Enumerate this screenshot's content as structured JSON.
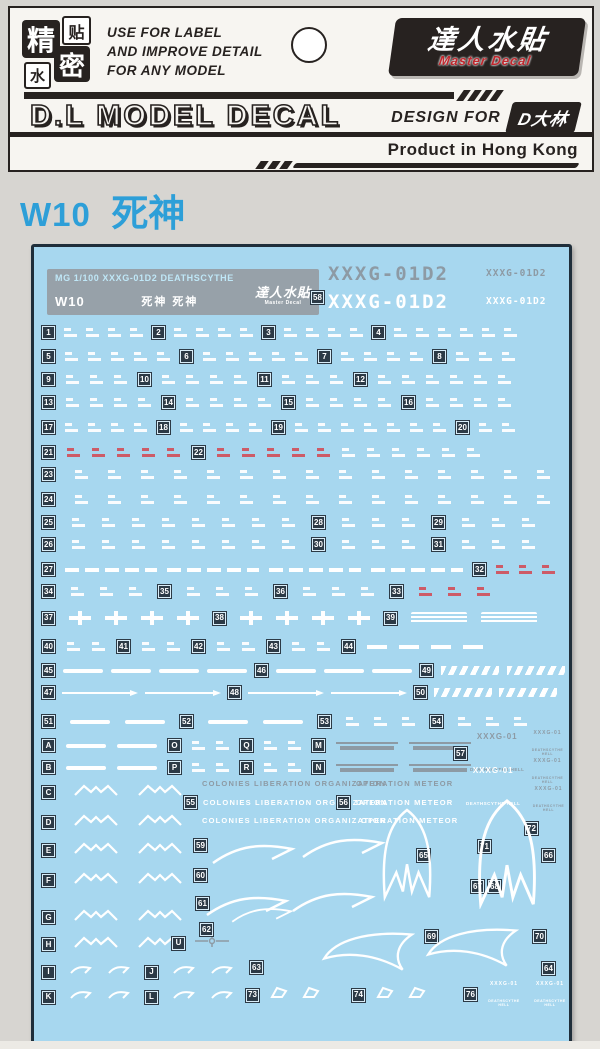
{
  "colors": {
    "page_bg": "#d7d5d1",
    "card_bg": "#f7f5f1",
    "ink": "#272220",
    "accent_red": "#c0272d",
    "title_blue": "#2d9fd8",
    "sheet_bg": "#a7d7ef",
    "sheet_border": "#1f2e3a",
    "badge_bg": "#2c3a46",
    "decal_white": "#ffffff",
    "decal_gray": "#8d9aa4",
    "decal_red": "#d05560",
    "info_box": "#97a1a9",
    "strip_bg": "#eceae5"
  },
  "header": {
    "stamp": [
      "精",
      "贴",
      "水",
      "密"
    ],
    "tagline": [
      "USE FOR LABEL",
      "AND IMPROVE DETAIL",
      "FOR ANY MODEL"
    ],
    "brand": {
      "cn": "達人水貼",
      "en": "Master Decal"
    },
    "title": "D.L MODEL DECAL",
    "design_for": "DESIGN FOR",
    "designer": "D大林",
    "origin": "Product in Hong Kong"
  },
  "sheet_title": {
    "code": "W10",
    "name": "死神"
  },
  "sheet": {
    "info": {
      "line1": "MG 1/100 XXXG-01D2 DEATHSCYTHE",
      "code": "W10",
      "name": "死神 死神",
      "logo_cn": "達人水貼",
      "logo_en": "Master Decal"
    },
    "badge58": "58",
    "codes": [
      {
        "text": "XXXG-01D2",
        "x": 294,
        "y": 16,
        "size": "lg",
        "color": "gray"
      },
      {
        "text": "XXXG-01D2",
        "x": 452,
        "y": 21,
        "size": "sm",
        "color": "gray"
      },
      {
        "text": "XXXG-01D2",
        "x": 294,
        "y": 44,
        "size": "lg",
        "color": "white"
      },
      {
        "text": "XXXG-01D2",
        "x": 452,
        "y": 49,
        "size": "sm",
        "color": "white"
      }
    ],
    "emblem": {
      "top": "XXXG-01",
      "num": "02",
      "sub": "DEATHSCYTHE HELL"
    },
    "texts": {
      "colonies": "COLONIES LIBERATION ORGANIZATION",
      "meteor": "OPERATION METEOR"
    },
    "rows": [
      {
        "y": 79,
        "gap": 9,
        "cells": [
          [
            "b",
            "1"
          ],
          [
            "g",
            4
          ],
          [
            "b",
            "2"
          ],
          [
            "g",
            4
          ],
          [
            "b",
            "3"
          ],
          [
            "g",
            4
          ],
          [
            "b",
            "4"
          ],
          [
            "g",
            6
          ]
        ]
      },
      {
        "y": 103,
        "gap": 10,
        "cells": [
          [
            "b",
            "5"
          ],
          [
            "g",
            5
          ],
          [
            "b",
            "6"
          ],
          [
            "g",
            5
          ],
          [
            "b",
            "7"
          ],
          [
            "g",
            4
          ],
          [
            "b",
            "8"
          ],
          [
            "g",
            3
          ]
        ]
      },
      {
        "y": 126,
        "gap": 11,
        "cells": [
          [
            "b",
            "9"
          ],
          [
            "g",
            3
          ],
          [
            "b",
            "10"
          ],
          [
            "g",
            4
          ],
          [
            "b",
            "11"
          ],
          [
            "g",
            3
          ],
          [
            "b",
            "12"
          ],
          [
            "g",
            6
          ]
        ]
      },
      {
        "y": 149,
        "gap": 11,
        "cells": [
          [
            "b",
            "13"
          ],
          [
            "g",
            4
          ],
          [
            "b",
            "14"
          ],
          [
            "g",
            4
          ],
          [
            "b",
            "15"
          ],
          [
            "g",
            4
          ],
          [
            "b",
            "16"
          ],
          [
            "g",
            4
          ]
        ]
      },
      {
        "y": 174,
        "gap": 10,
        "cells": [
          [
            "b",
            "17"
          ],
          [
            "g",
            4
          ],
          [
            "b",
            "18"
          ],
          [
            "g",
            4
          ],
          [
            "b",
            "19"
          ],
          [
            "g",
            7
          ],
          [
            "b",
            "20"
          ],
          [
            "g",
            2
          ]
        ]
      },
      {
        "y": 199,
        "gap": 12,
        "cells": [
          [
            "b",
            "21"
          ],
          [
            "r",
            5
          ],
          [
            "b",
            "22"
          ],
          [
            "r",
            5
          ],
          [
            "g",
            6
          ]
        ]
      },
      {
        "y": 221,
        "gap": 20,
        "cells": [
          [
            "b",
            "23"
          ],
          [
            "g",
            15
          ]
        ]
      },
      {
        "y": 246,
        "gap": 20,
        "cells": [
          [
            "b",
            "24"
          ],
          [
            "g",
            15
          ]
        ]
      },
      {
        "y": 269,
        "gap": 17,
        "cells": [
          [
            "b",
            "25"
          ],
          [
            "g",
            8
          ],
          [
            "b",
            "28"
          ],
          [
            "g",
            3
          ],
          [
            "b",
            "29"
          ],
          [
            "g",
            3
          ]
        ]
      },
      {
        "y": 291,
        "gap": 17,
        "cells": [
          [
            "b",
            "26"
          ],
          [
            "g",
            8
          ],
          [
            "b",
            "30"
          ],
          [
            "g",
            3
          ],
          [
            "b",
            "31"
          ],
          [
            "g",
            3
          ]
        ]
      },
      {
        "y": 316,
        "gap": 10,
        "cells": [
          [
            "b",
            "27"
          ],
          [
            "ld",
            4
          ],
          [
            "b",
            "32"
          ],
          [
            "r",
            3
          ]
        ]
      },
      {
        "y": 338,
        "gap": 16,
        "cells": [
          [
            "b",
            "34"
          ],
          [
            "g",
            3
          ],
          [
            "b",
            "35"
          ],
          [
            "g",
            3
          ],
          [
            "b",
            "36"
          ],
          [
            "g",
            3
          ],
          [
            "b",
            "33"
          ],
          [
            "r",
            3
          ]
        ]
      },
      {
        "y": 364,
        "gap": 14,
        "cells": [
          [
            "b",
            "37"
          ],
          [
            "x",
            4
          ],
          [
            "b",
            "38"
          ],
          [
            "x",
            4
          ],
          [
            "b",
            "39"
          ],
          [
            "sb",
            2
          ]
        ]
      },
      {
        "y": 393,
        "gap": 12,
        "cells": [
          [
            "b",
            "40"
          ],
          [
            "g",
            2
          ],
          [
            "b",
            "41"
          ],
          [
            "g",
            2
          ],
          [
            "b",
            "42"
          ],
          [
            "g",
            2
          ],
          [
            "b",
            "43"
          ],
          [
            "g",
            2
          ],
          [
            "b",
            "44"
          ],
          [
            "ds",
            4
          ]
        ]
      },
      {
        "y": 417,
        "gap": 8,
        "cells": [
          [
            "b",
            "45"
          ],
          [
            "br",
            4
          ],
          [
            "b",
            "46"
          ],
          [
            "br",
            3
          ],
          [
            "b",
            "49"
          ],
          [
            "ht",
            2
          ]
        ]
      },
      {
        "y": 439,
        "gap": 7,
        "cells": [
          [
            "b",
            "47"
          ],
          [
            "ar",
            2
          ],
          [
            "b",
            "48"
          ],
          [
            "ar",
            2
          ],
          [
            "b",
            "50"
          ],
          [
            "ht",
            2
          ]
        ]
      },
      {
        "y": 468,
        "gap": 15,
        "cells": [
          [
            "b",
            "51"
          ],
          [
            "br",
            2
          ],
          [
            "b",
            "52"
          ],
          [
            "br",
            2
          ],
          [
            "b",
            "53"
          ],
          [
            "g",
            3
          ],
          [
            "b",
            "54"
          ],
          [
            "g",
            3
          ]
        ]
      },
      {
        "y": 492,
        "gap": 11,
        "cells": [
          [
            "b",
            "A"
          ],
          [
            "br",
            2
          ],
          [
            "b",
            "O"
          ],
          [
            "g",
            2
          ],
          [
            "b",
            "Q"
          ],
          [
            "g",
            2
          ],
          [
            "b",
            "M"
          ],
          [
            "gb",
            2
          ]
        ]
      },
      {
        "y": 514,
        "gap": 11,
        "cells": [
          [
            "b",
            "B"
          ],
          [
            "br",
            2
          ],
          [
            "b",
            "P"
          ],
          [
            "g",
            2
          ],
          [
            "b",
            "R"
          ],
          [
            "g",
            2
          ],
          [
            "b",
            "N"
          ],
          [
            "gb",
            2
          ]
        ]
      },
      {
        "y": 536,
        "gap": 18,
        "cells": [
          [
            "b",
            "C"
          ],
          [
            "wg",
            2
          ]
        ]
      },
      {
        "y": 566,
        "gap": 18,
        "cells": [
          [
            "b",
            "D"
          ],
          [
            "wg",
            2
          ]
        ]
      },
      {
        "y": 594,
        "gap": 18,
        "cells": [
          [
            "b",
            "E"
          ],
          [
            "wg",
            2
          ]
        ]
      },
      {
        "y": 624,
        "gap": 18,
        "cells": [
          [
            "b",
            "F"
          ],
          [
            "wg",
            2
          ]
        ]
      },
      {
        "y": 661,
        "gap": 18,
        "cells": [
          [
            "b",
            "G"
          ],
          [
            "wg",
            2
          ]
        ]
      },
      {
        "y": 688,
        "gap": 18,
        "cells": [
          [
            "b",
            "H"
          ],
          [
            "wg",
            2
          ]
        ]
      },
      {
        "x": 138,
        "y": 687,
        "gap": 10,
        "cells": [
          [
            "b",
            "U"
          ],
          [
            "ch",
            1
          ]
        ]
      },
      {
        "y": 716,
        "gap": 14,
        "cells": [
          [
            "b",
            "I"
          ],
          [
            "hk",
            2
          ],
          [
            "b",
            "J"
          ],
          [
            "hk",
            2
          ]
        ]
      },
      {
        "y": 741,
        "gap": 14,
        "cells": [
          [
            "b",
            "K"
          ],
          [
            "hk",
            2
          ],
          [
            "b",
            "L"
          ],
          [
            "hk",
            2
          ]
        ]
      },
      {
        "x": 212,
        "y": 738,
        "gap": 10,
        "cells": [
          [
            "b",
            "73"
          ],
          [
            "bk",
            2
          ]
        ]
      },
      {
        "x": 318,
        "y": 738,
        "gap": 10,
        "cells": [
          [
            "b",
            "74"
          ],
          [
            "bk",
            2
          ]
        ]
      },
      {
        "x": 430,
        "y": 735,
        "gap": 8,
        "cells": [
          [
            "b",
            "76"
          ],
          [
            "em",
            "small",
            "white"
          ],
          [
            "em",
            "small",
            "white"
          ]
        ]
      },
      {
        "x": 168,
        "y": 532,
        "gap": 6,
        "cells": [
          [
            "t",
            "colonies",
            "t-gray"
          ]
        ]
      },
      {
        "x": 322,
        "y": 532,
        "gap": 6,
        "cells": [
          [
            "t",
            "meteor",
            "t-gray"
          ]
        ]
      },
      {
        "x": 150,
        "y": 549,
        "gap": 6,
        "cells": [
          [
            "b",
            "55"
          ],
          [
            "t",
            "colonies",
            "t-white"
          ]
        ]
      },
      {
        "x": 303,
        "y": 549,
        "gap": 6,
        "cells": [
          [
            "b",
            "56"
          ],
          [
            "t",
            "meteor",
            "t-white"
          ]
        ]
      },
      {
        "x": 168,
        "y": 569,
        "gap": 6,
        "cells": [
          [
            "t",
            "colonies",
            "t-white"
          ]
        ]
      },
      {
        "x": 327,
        "y": 569,
        "gap": 6,
        "cells": [
          [
            "t",
            "meteor",
            "t-white"
          ]
        ]
      }
    ],
    "float_badges": [
      {
        "label": "57",
        "x": 420,
        "y": 500
      },
      {
        "label": "59",
        "x": 160,
        "y": 592
      },
      {
        "label": "60",
        "x": 160,
        "y": 622
      },
      {
        "label": "61",
        "x": 162,
        "y": 650
      },
      {
        "label": "62",
        "x": 166,
        "y": 676
      },
      {
        "label": "63",
        "x": 216,
        "y": 714
      },
      {
        "label": "64",
        "x": 508,
        "y": 715
      },
      {
        "label": "65",
        "x": 383,
        "y": 602
      },
      {
        "label": "66",
        "x": 508,
        "y": 602
      },
      {
        "label": "67",
        "x": 437,
        "y": 633
      },
      {
        "label": "68",
        "x": 454,
        "y": 633
      },
      {
        "label": "69",
        "x": 391,
        "y": 683
      },
      {
        "label": "70",
        "x": 499,
        "y": 683
      },
      {
        "label": "71",
        "x": 444,
        "y": 593
      },
      {
        "label": "72",
        "x": 491,
        "y": 575
      }
    ],
    "float_emblems": [
      {
        "x": 436,
        "y": 486,
        "size": "big",
        "color": "gray"
      },
      {
        "x": 492,
        "y": 484,
        "size": "small",
        "color": "gray"
      },
      {
        "x": 432,
        "y": 520,
        "size": "big",
        "color": "white"
      },
      {
        "x": 492,
        "y": 512,
        "size": "small",
        "color": "gray"
      },
      {
        "x": 494,
        "y": 540,
        "size": "small",
        "color": "gray"
      }
    ],
    "art": [
      {
        "kind": "bigwing",
        "x": 336,
        "y": 556,
        "w": 74,
        "h": 102
      },
      {
        "kind": "bigwing",
        "x": 428,
        "y": 550,
        "w": 90,
        "h": 112
      },
      {
        "kind": "swoosh",
        "x": 176,
        "y": 594,
        "w": 86,
        "h": 26
      },
      {
        "kind": "swoosh",
        "x": 266,
        "y": 588,
        "w": 86,
        "h": 26
      },
      {
        "kind": "swoosh",
        "x": 170,
        "y": 646,
        "w": 86,
        "h": 26
      },
      {
        "kind": "swoosh",
        "x": 256,
        "y": 642,
        "w": 86,
        "h": 26
      },
      {
        "kind": "swoosh",
        "x": 196,
        "y": 658,
        "w": 64,
        "h": 20
      },
      {
        "kind": "crescent",
        "x": 284,
        "y": 682,
        "w": 100,
        "h": 48
      },
      {
        "kind": "crescent",
        "x": 388,
        "y": 678,
        "w": 100,
        "h": 48
      }
    ]
  }
}
